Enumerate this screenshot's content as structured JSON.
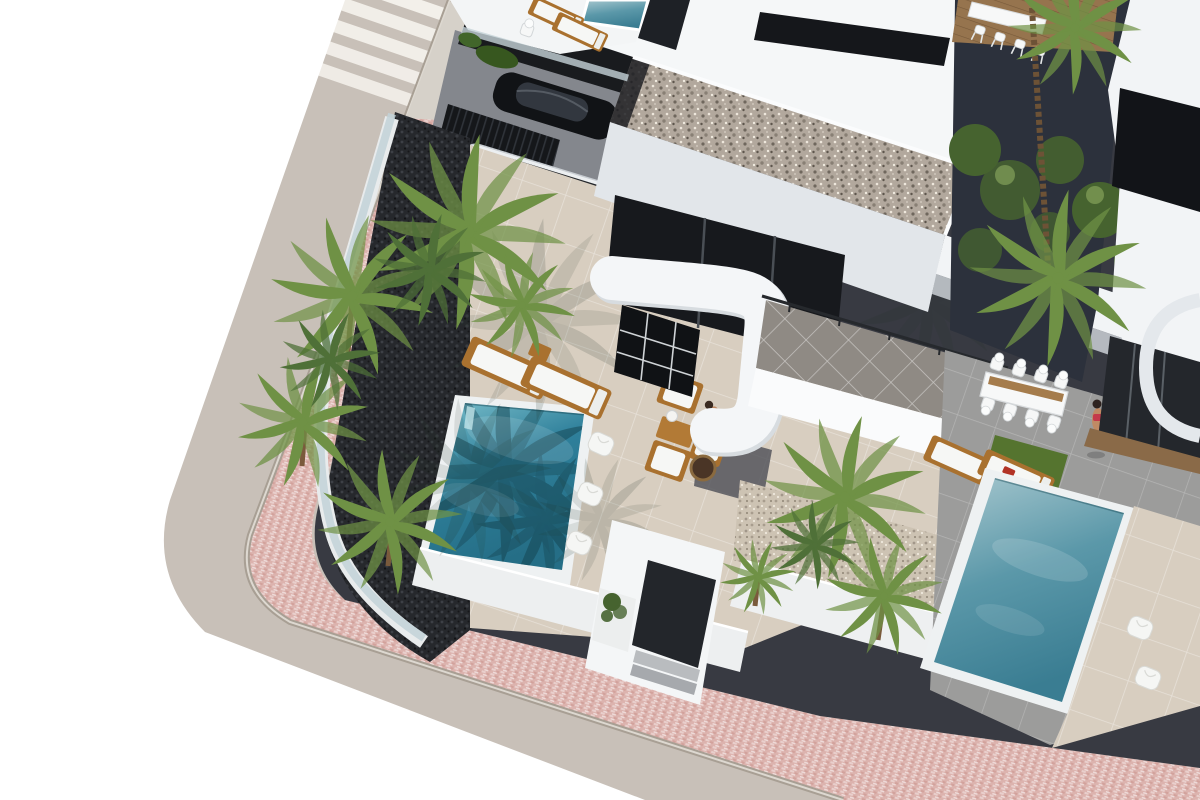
{
  "meta": {
    "description": "Aerial 3D architectural render of modern white villas on a street corner: central villa with gravel flat roof, curved white parapet, carport with a white SUV and a black sedan, turquoise private pool with wooden sun loungers and poufs, palm planters with dark gravel, entrance porch, neighbouring villa at right with grey terrace, white dining set, second pool and two women, pink paved sidewalk and zebra crosswalk along the road"
  },
  "colors": {
    "page_bg": "#ffffff",
    "road": "#c8c0b8",
    "crosswalk": "#f3f0ea",
    "curb": "#a89f94",
    "sidewalk_base": "#dcb3ae",
    "sidewalk_light": "#e9cfcc",
    "sidewalk_dark": "#d2a29c",
    "concrete_landing": "#d6d1c9",
    "ground_dark": "#383a42",
    "driveway": "#84878d",
    "planter_gravel_base": "#26282c",
    "wall_white": "#f5f7f8",
    "wall_shade": "#e2e6ea",
    "glass_dark": "#17191d",
    "glass_fence": "#c2d2d8",
    "roof_gravel_base": "#b2a89d",
    "light_gravel_base": "#cdc3b3",
    "terrace_beige": "#d8cec0",
    "terrace_gray": "#9c9c9b",
    "upper_terrace": "#8f8a84",
    "grass": "#55742f",
    "palm_green": "#6f9145",
    "palm_shadow": "#24372b",
    "tree_green": "#46632f",
    "wood": "#a9712f",
    "deck_wood": "#96744e",
    "cushion": "#f6f7f5",
    "car_white": "#eceff1",
    "car_black": "#111316",
    "skin": "#c08a64",
    "towel_red": "#b23326",
    "fence_dark": "#15171a",
    "navy_wall": "#2c313c",
    "water_rim": "#eef1f2",
    "pool_left_light": "#7cc0cc",
    "pool_left_mid": "#2f809b",
    "pool_left_deep": "#256e86",
    "pool_right_light": "#a8c8cf",
    "pool_right_mid": "#5b98a9",
    "pool_right_deep": "#3a7d92"
  },
  "objects": [
    {
      "name": "street-road",
      "label": "asphalt corner street"
    },
    {
      "name": "crosswalk",
      "label": "zebra pedestrian crossing"
    },
    {
      "name": "sidewalk",
      "label": "pink paved sidewalk"
    },
    {
      "name": "main-villa",
      "label": "central white modern villa"
    },
    {
      "name": "gravel-roof",
      "label": "flat gravel roof"
    },
    {
      "name": "curved-parapet",
      "label": "curved white stair parapet"
    },
    {
      "name": "left-pool",
      "label": "turquoise private pool"
    },
    {
      "name": "right-pool",
      "label": "neighbour villa pool"
    },
    {
      "name": "white-suv",
      "label": "white SUV in carport"
    },
    {
      "name": "black-sedan",
      "label": "black sedan in carport"
    },
    {
      "name": "sun-loungers",
      "label": "wooden sun loungers with white pads"
    },
    {
      "name": "poufs",
      "label": "white poolside poufs"
    },
    {
      "name": "patio-set",
      "label": "wooden lounge set with lamp and fire bowl"
    },
    {
      "name": "dining-set",
      "label": "white outdoor dining table with chairs"
    },
    {
      "name": "bar-set",
      "label": "high table with white bar stools"
    },
    {
      "name": "palm-trees",
      "label": "fan palms in dark gravel planters"
    },
    {
      "name": "entrance-porch",
      "label": "entrance porch with dark door"
    },
    {
      "name": "standing-woman",
      "label": "woman in swimsuit walking"
    },
    {
      "name": "sitting-woman",
      "label": "woman seated on lounger"
    },
    {
      "name": "seated-person",
      "label": "person seated on patio sofa"
    }
  ]
}
